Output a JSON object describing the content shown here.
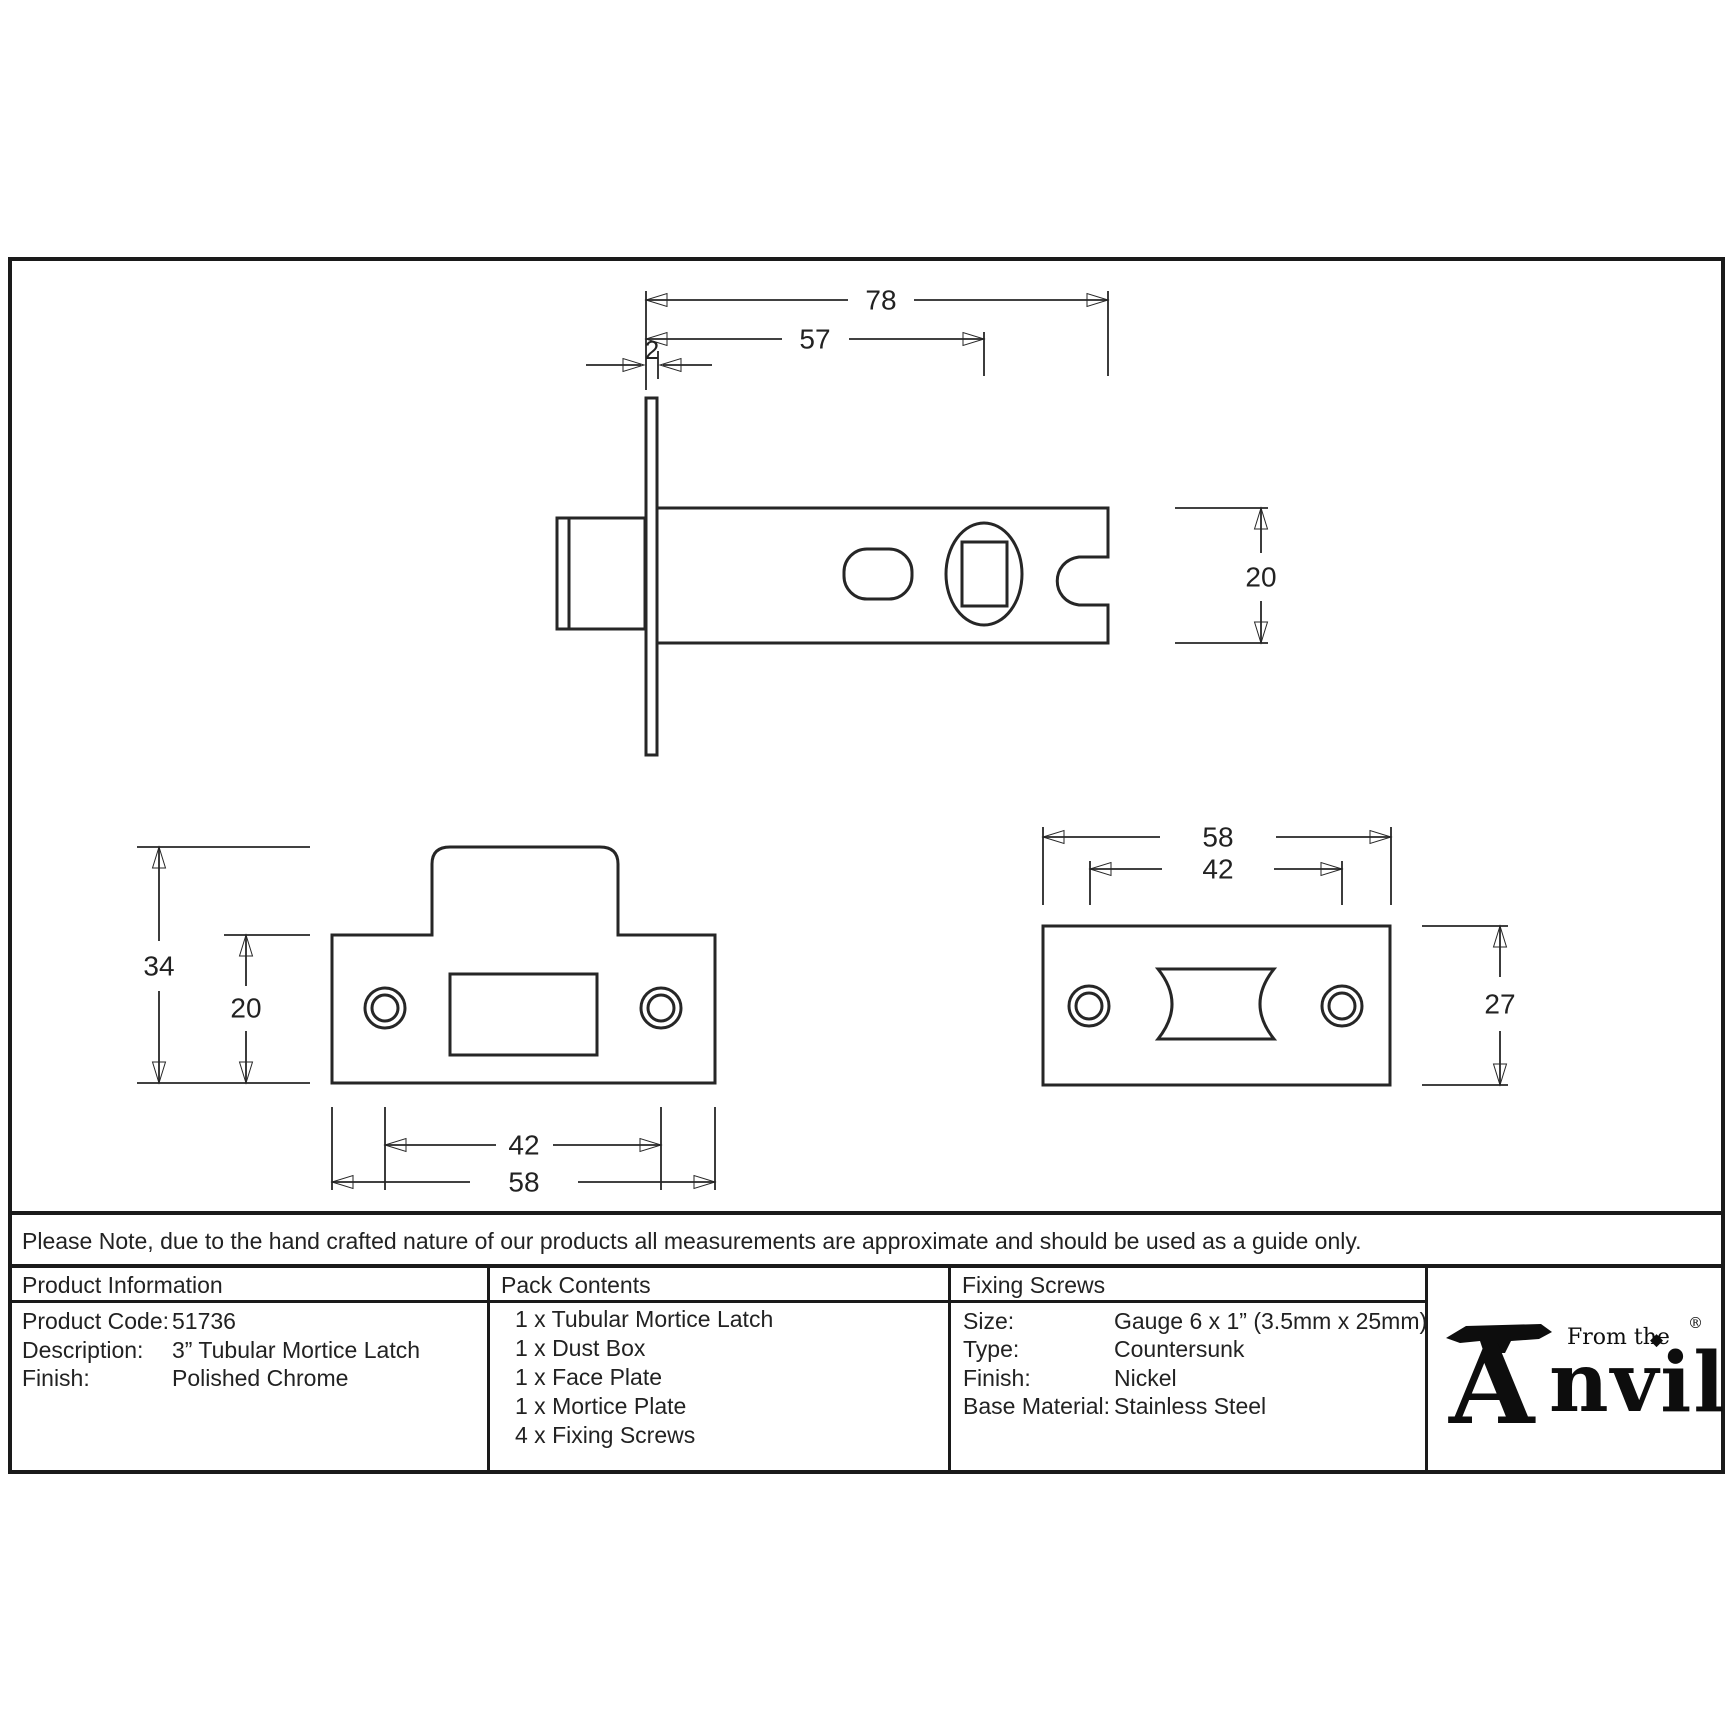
{
  "note": "Please Note, due to the hand crafted nature of our products all measurements are approximate and should be used as a guide only.",
  "drawings": {
    "latch_side_view": {
      "overall_length": "78",
      "backset": "57",
      "faceplate_thickness": "2",
      "body_height": "20"
    },
    "face_plate_view": {
      "overall_height": "34",
      "plate_height": "20",
      "hole_spacing": "42",
      "plate_width": "58"
    },
    "mortice_plate_view": {
      "plate_width": "58",
      "hole_spacing": "42",
      "plate_height": "27"
    }
  },
  "table": {
    "product_information": {
      "header": "Product Information",
      "rows": [
        {
          "label": "Product Code:",
          "value": "51736"
        },
        {
          "label": "Description:",
          "value": "3” Tubular Mortice Latch"
        },
        {
          "label": "Finish:",
          "value": "Polished Chrome"
        }
      ]
    },
    "pack_contents": {
      "header": "Pack Contents",
      "items": [
        "1 x Tubular Mortice Latch",
        "1 x Dust Box",
        "1 x Face Plate",
        "1 x Mortice Plate",
        "4 x Fixing Screws"
      ]
    },
    "fixing_screws": {
      "header": "Fixing Screws",
      "rows": [
        {
          "label": "Size:",
          "value": "Gauge 6 x 1” (3.5mm x 25mm)"
        },
        {
          "label": "Type:",
          "value": "Countersunk"
        },
        {
          "label": "Finish:",
          "value": "Nickel"
        },
        {
          "label": "Base Material:",
          "value": "Stainless Steel"
        }
      ]
    }
  },
  "logo": {
    "from_the": "From the",
    "initial": "A",
    "rest": "nvil",
    "diamond": "◆",
    "registered": "®"
  },
  "colors": {
    "line": "#262626",
    "border": "#1a1a1a",
    "background": "#ffffff"
  }
}
